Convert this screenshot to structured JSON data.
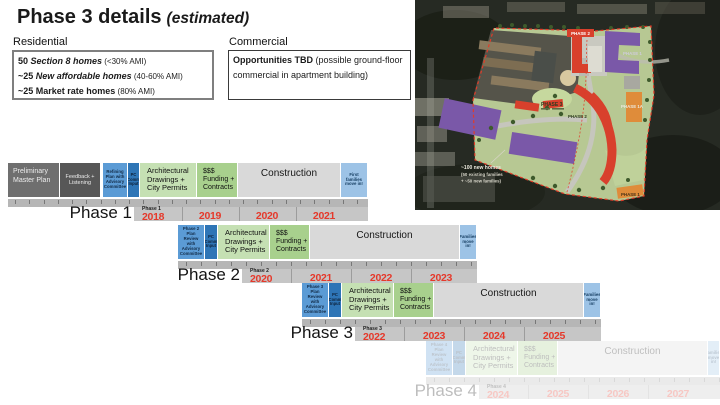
{
  "title": {
    "main": "Phase 3 details",
    "qualifier": "(estimated)"
  },
  "residential": {
    "heading": "Residential",
    "items": [
      {
        "prefix": "50 ",
        "emphasis": "Section 8 homes",
        "suffix": " (<30% AMI)"
      },
      {
        "prefix": "~25 ",
        "emphasis": "New affordable homes",
        "suffix": " (40-60% AMI)"
      },
      {
        "prefix": "~25 ",
        "emphasis": "Market rate homes",
        "suffix": " (80% AMI)"
      }
    ]
  },
  "commercial": {
    "heading": "Commercial",
    "bold": "Opportunities TBD",
    "rest": " (possible ground-floor commercial in apartment building)"
  },
  "site_map": {
    "labels": {
      "phase2_top": "PHASE 2",
      "phase1_right": "PHASE 1",
      "phase3_center": "PHASE 3",
      "phase2_mid": "PHASE 2",
      "phase1a": "PHASE 1A",
      "phase1_bottom": "PHASE 1"
    },
    "annotation": [
      "~100 new homes",
      "(50 existing families",
      "+ ~50 new families)"
    ]
  },
  "timeline": {
    "phases": [
      {
        "name": "Phase 1",
        "year_label": "Phase 1",
        "years": [
          "2018",
          "2019",
          "2020",
          "2021"
        ],
        "faded": false,
        "stages": [
          {
            "type": "pmp",
            "label": "Preliminary Master Plan"
          },
          {
            "type": "feedback",
            "label": "Feedback + Listening"
          },
          {
            "type": "refine",
            "label": "Refining Plan with Advisory Committee"
          },
          {
            "type": "pc",
            "label": "PC Comm Input"
          },
          {
            "type": "arch",
            "label": "Architectural Drawings + City Permits"
          },
          {
            "type": "funding",
            "label": "$$$ Funding + Contracts"
          },
          {
            "type": "construction",
            "label": "Construction"
          },
          {
            "type": "movein",
            "label": "First families move in!"
          }
        ]
      },
      {
        "name": "Phase 2",
        "year_label": "Phase 2",
        "years": [
          "2020",
          "2021",
          "2022",
          "2023"
        ],
        "faded": false,
        "stages": [
          {
            "type": "refine",
            "label": "Phase 2 Plan Review with Advisory Committee"
          },
          {
            "type": "pc",
            "label": "PC Comm Input"
          },
          {
            "type": "arch",
            "label": "Architectural Drawings + City Permits"
          },
          {
            "type": "funding",
            "label": "$$$ Funding + Contracts"
          },
          {
            "type": "construction",
            "label": "Construction"
          },
          {
            "type": "movein",
            "label": "Families move in!"
          }
        ]
      },
      {
        "name": "Phase 3",
        "year_label": "Phase 3",
        "years": [
          "2022",
          "2023",
          "2024",
          "2025"
        ],
        "faded": false,
        "stages": [
          {
            "type": "refine",
            "label": "Phase 3 Plan Review with Advisory Committee"
          },
          {
            "type": "pc",
            "label": "PC Comm Input"
          },
          {
            "type": "arch",
            "label": "Architectural Drawings + City Permits"
          },
          {
            "type": "funding",
            "label": "$$$ Funding + Contracts"
          },
          {
            "type": "construction",
            "label": "Construction"
          },
          {
            "type": "movein",
            "label": "Families move in!"
          }
        ]
      },
      {
        "name": "Phase 4",
        "year_label": "Phase 4",
        "years": [
          "2024",
          "2025",
          "2026",
          "2027"
        ],
        "faded": true,
        "stages": [
          {
            "type": "refine",
            "label": "Phase 4 Plan Review with Advisory Committee"
          },
          {
            "type": "pc",
            "label": "PC Comm Input"
          },
          {
            "type": "arch",
            "label": "Architectural Drawings + City Permits"
          },
          {
            "type": "funding",
            "label": "$$$ Funding + Contracts"
          },
          {
            "type": "construction",
            "label": "Construction"
          },
          {
            "type": "movein",
            "label": "Families move in!"
          }
        ]
      }
    ]
  },
  "colors": {
    "stage_gray_dark": "#6f6f6f",
    "stage_gray_darker": "#575757",
    "stage_blue": "#5b9bd5",
    "stage_blue_dark": "#2e75b6",
    "stage_green_light": "#c5e0b3",
    "stage_green": "#a8d08d",
    "stage_construction": "#d9d9d9",
    "stage_movein": "#9dc3e6",
    "year_red": "#e5392b",
    "plan_green": "#b7c893",
    "building_purple": "#7a58a8",
    "building_red": "#d8402c",
    "building_orange": "#df8c3a"
  }
}
